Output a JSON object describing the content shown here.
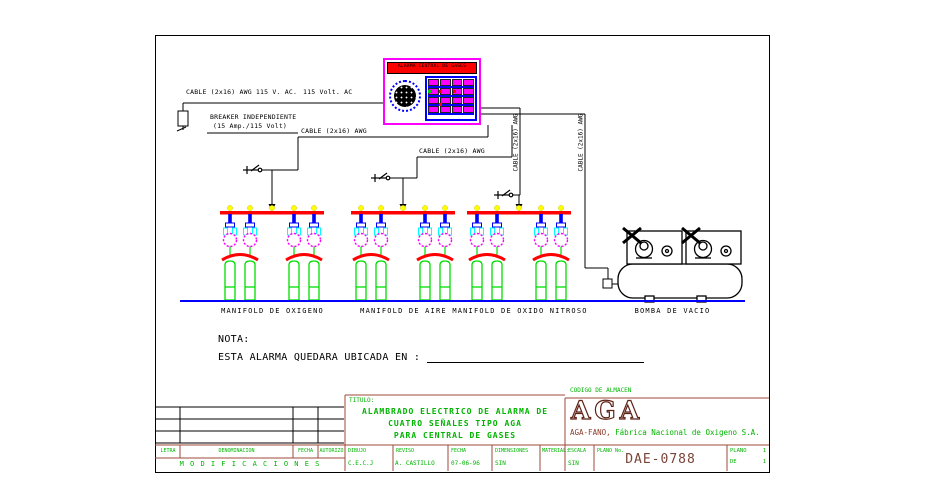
{
  "colors": {
    "wire_black": "#000000",
    "header_bus_red": "#ff0000",
    "cylinder_green": "#00dd00",
    "gauge_magenta": "#ff00ff",
    "riser_blue": "#0000ff",
    "connection_yellow": "#ffff00",
    "detail_cyan": "#00ffff",
    "baseline_blue": "#0000ff",
    "titleblock_green": "#00b400",
    "titleblock_maroon": "#9c4a3a",
    "logo_maroon": "#5f2317",
    "panel_border_magenta": "#ff00ff",
    "panel_titlebar_red": "#ff0000"
  },
  "alarm_panel": {
    "title": "ALARMA CENTRAL DE GASES"
  },
  "wiring": {
    "cable_awg_115": "CABLE (2x16) AWG 115 V. AC.",
    "volt_ac": "115 Volt. AC",
    "breaker_line1": "BREAKER INDEPENDIENTE",
    "breaker_line2": "(15 Amp./115 Volt)",
    "cable_awg": "CABLE (2x16) AWG"
  },
  "equipment": [
    "MANIFOLD DE OXIGENO",
    "MANIFOLD DE AIRE",
    "MANIFOLD DE OXIDO NITROSO",
    "BOMBA DE VACIO"
  ],
  "note": {
    "heading": "NOTA:",
    "text": "ESTA ALARMA QUEDARA UBICADA EN :"
  },
  "title_block": {
    "modifications": {
      "columns": [
        "LETRA",
        "DENOMINACION",
        "FECHA",
        "AUTORIZO"
      ],
      "caption": "M O D I F I C A C I O N E S"
    },
    "titulo_label": "TITULO:",
    "title_lines": [
      "ALAMBRADO ELECTRICO DE ALARMA DE",
      "CUATRO SEÑALES TIPO AGA",
      "PARA CENTRAL DE GASES"
    ],
    "fields": [
      {
        "label": "DIBUJO",
        "value": "C.E.C.J"
      },
      {
        "label": "REVISO",
        "value": "A. CASTILLO"
      },
      {
        "label": "FECHA",
        "value": "07-06-96"
      },
      {
        "label": "DIMENSIONES",
        "value": "SIN"
      },
      {
        "label": "MATERIAL:",
        "value": ""
      }
    ],
    "codigo_almacen": "CODIGO DE ALMACEN",
    "logo_text": "AGA",
    "company_brand": "AGA-FANO,",
    "company_name": "Fábrica Nacional de Oxigeno S.A.",
    "escala": {
      "label": "ESCALA",
      "value": "SIN"
    },
    "plano_no": {
      "label": "PLANO No.",
      "value": "DAE-0788"
    },
    "sheet": {
      "label1": "PLANO",
      "num1": "1",
      "label2": "DE",
      "num2": "1"
    }
  }
}
